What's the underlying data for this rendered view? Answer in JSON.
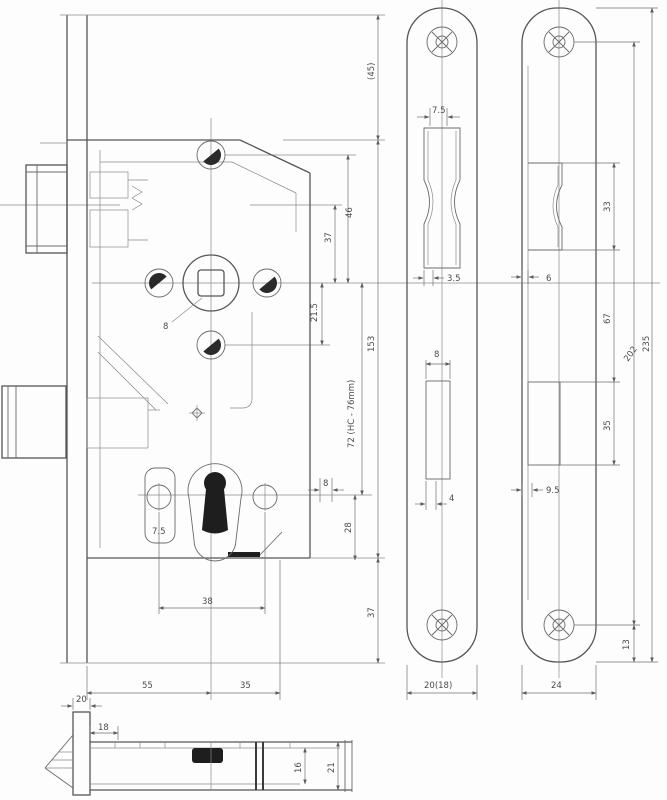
{
  "drawing": {
    "kind": "mortise-lock technical drawing",
    "background": "#fdfdfd",
    "line_color": "#6a6a6a",
    "dark_fill": "#1e1e1e"
  },
  "dims": {
    "main": {
      "top_gap": "(45)",
      "hole_spacing_46": "46",
      "dim_37": "37",
      "dim_215": "21.5",
      "case_height": "153",
      "centres": "72 (HC - 76mm)",
      "follower_square": "8",
      "key_dim_8": "8",
      "dim_28": "28",
      "dim_75": "7.5",
      "cylinder_span": "38",
      "bottom_gap": "37",
      "backset": "55",
      "dim_35": "35"
    },
    "face_plate": {
      "latch_top": "7.5",
      "latch_bottom": "3.5",
      "bolt_top": "8",
      "bolt_bottom": "4",
      "width": "20(18)"
    },
    "strike_plate": {
      "latch_cutout": "33",
      "lip": "6",
      "between": "67",
      "screw_centres": "202",
      "length": "235",
      "bolt_cutout": "35",
      "bolt_offset": "9.5",
      "bottom_offset": "13",
      "width": "24"
    },
    "bottom_view": {
      "plate_width": "20",
      "inner": "18",
      "case_inner": "16",
      "case_overall": "21"
    }
  }
}
